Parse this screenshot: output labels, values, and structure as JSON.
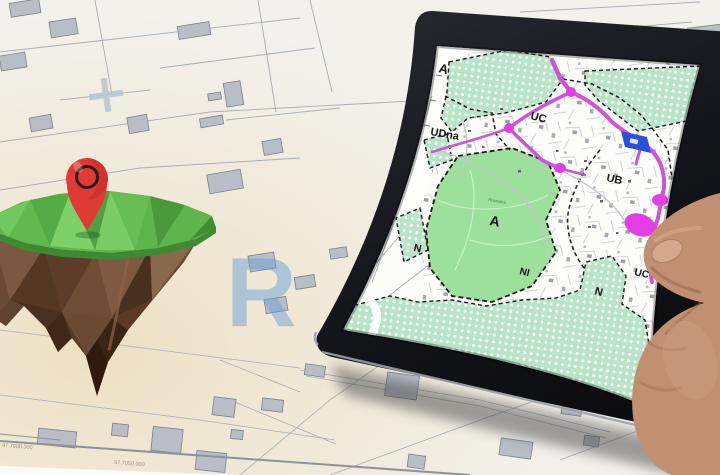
{
  "scene": {
    "title": "Hand holding a tablet with a zoning plan over a paper cadastral map, beside a 3D floating island with a red location pin"
  },
  "background_map": {
    "grid_line_labels": [
      {
        "text": "97.7900.000"
      },
      {
        "text": "97.7050.000"
      }
    ],
    "watermark_letter": "R"
  },
  "island": {
    "pin_icon": "location-pin"
  },
  "tablet": {
    "screen_map": {
      "zone_labels": [
        {
          "text": "A"
        },
        {
          "text": "UC"
        },
        {
          "text": "UDna"
        },
        {
          "text": "UB"
        },
        {
          "text": "A"
        },
        {
          "text": "N"
        },
        {
          "text": "Nl"
        },
        {
          "text": "N"
        },
        {
          "text": "UC"
        }
      ],
      "place_label": "Rovnière"
    }
  },
  "colors": {
    "paper": "#f2f1ec",
    "parcel_line": "#a9aeb6",
    "building_gray": "#b9bdc6",
    "building_stroke": "#7c818b",
    "watermark_blue": "#6aa2d8",
    "island_green": "#5fb44d",
    "island_green_dark": "#3e8a33",
    "island_brown": "#6b4a35",
    "pin_red": "#e03a34",
    "pin_ring": "#2b1d18",
    "bezel_black": "#17181c",
    "screen_white": "#fcfcf9",
    "mint_zone": "#b7e3c6",
    "green_zone": "#9ce09c",
    "road_magenta": "#cf52d8",
    "road_magenta_bright": "#e23ee6",
    "building_blue": "#2b4fd7",
    "boundary_black": "#1b1b1b",
    "skin": "#c09070",
    "nail": "#d3a88b"
  }
}
